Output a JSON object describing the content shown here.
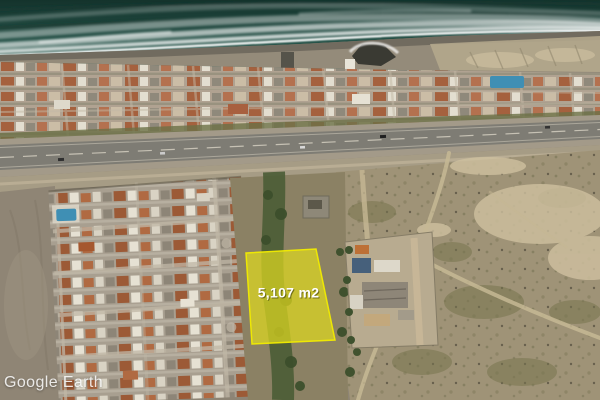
{
  "app": {
    "name_watermark": "Google Earth"
  },
  "overlay": {
    "parcel": {
      "area_label": "5,107 m2",
      "fill": "#ded81e",
      "fill_opacity": "0.72",
      "stroke": "#f1eb00",
      "label_color": "#ffffff"
    }
  },
  "scene": {
    "colors": {
      "ocean": "#245147",
      "foam": "#ffffff",
      "wet_sand": "#6b655a",
      "beach": "#948b7a",
      "dry_sand": "#c9bc9d",
      "urban_base": "#b0a291",
      "roof_terracotta": "#a5613e",
      "roof_white": "#e3ded0",
      "highway_asphalt": "#7e7c74",
      "highway_shoulder": "#a39a89",
      "dirt_field": "#8f8575",
      "scrubland": "#9f9377",
      "greenbelt": "#4a5c35",
      "dirt_road": "#c6b894",
      "pool_water": "#3f8fb4"
    }
  }
}
